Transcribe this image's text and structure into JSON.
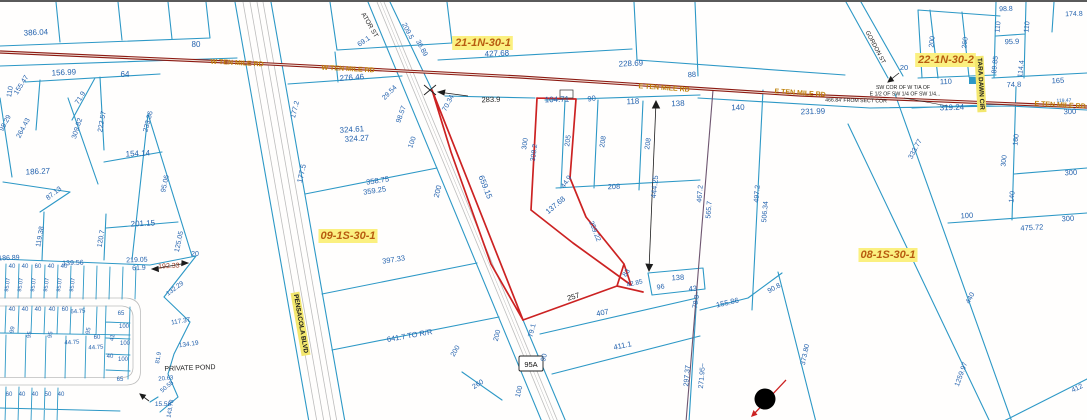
{
  "map": {
    "shield": "95A",
    "colors": {
      "parcel_line": "#2d98c6",
      "dimension_label": "#2563ae",
      "road_centerline": "#8c1a12",
      "highlighted_parcel": "#cc2222",
      "section_label_text": "#b85c10",
      "label_highlight": "#fbf080",
      "street_label_highlight": "#f3e76e",
      "corridor_gray": "#bdbdbd",
      "quarter_section_line": "#6e5570",
      "road_name_text": "#bf8109",
      "black_text": "#1c1c1c",
      "dark_red_dim": "#9a3a20"
    },
    "labels": [
      {
        "t": "386.04",
        "x": 36,
        "y": 33,
        "r": -3,
        "s": 8
      },
      {
        "t": "80",
        "x": 196,
        "y": 45,
        "s": 8
      },
      {
        "t": "156.99",
        "x": 64,
        "y": 73,
        "r": -3,
        "s": 8
      },
      {
        "t": "64",
        "x": 125,
        "y": 75,
        "s": 8
      },
      {
        "t": "110",
        "x": 12,
        "y": 90,
        "r": -80,
        "s": 7
      },
      {
        "t": "155.47",
        "x": 23,
        "y": 84,
        "r": -58,
        "s": 7
      },
      {
        "t": "71.9",
        "x": 82,
        "y": 97,
        "r": -58,
        "s": 7
      },
      {
        "t": "222.57",
        "x": 104,
        "y": 120,
        "r": -80,
        "s": 7
      },
      {
        "t": "98.29",
        "x": 7,
        "y": 122,
        "r": -62,
        "s": 7
      },
      {
        "t": "264.43",
        "x": 25,
        "y": 127,
        "r": -62,
        "s": 7
      },
      {
        "t": "309.82",
        "x": 79,
        "y": 127,
        "r": -72,
        "s": 7
      },
      {
        "t": "233.36",
        "x": 150,
        "y": 120,
        "r": -75,
        "s": 7
      },
      {
        "t": "186.27",
        "x": 38,
        "y": 172,
        "r": -3,
        "s": 8
      },
      {
        "t": "87.13",
        "x": 55,
        "y": 193,
        "r": -38,
        "s": 7
      },
      {
        "t": "154.14",
        "x": 138,
        "y": 154,
        "r": -3,
        "s": 8
      },
      {
        "t": "119.38",
        "x": 42,
        "y": 235,
        "r": -80,
        "s": 7
      },
      {
        "t": "120.7",
        "x": 103,
        "y": 237,
        "r": -80,
        "s": 7
      },
      {
        "t": "201.15",
        "x": 143,
        "y": 224,
        "r": -3,
        "s": 8
      },
      {
        "t": "95.06",
        "x": 167,
        "y": 182,
        "r": -78,
        "s": 7
      },
      {
        "t": "125.05",
        "x": 181,
        "y": 240,
        "r": -78,
        "s": 7
      },
      {
        "t": "20",
        "x": 195,
        "y": 254,
        "s": 7
      },
      {
        "t": "186.89",
        "x": 9,
        "y": 258,
        "r": -2,
        "s": 7
      },
      {
        "t": "139.56",
        "x": 73,
        "y": 263,
        "r": -2,
        "s": 7
      },
      {
        "t": "219.05",
        "x": 137,
        "y": 260,
        "r": -2,
        "s": 7
      },
      {
        "t": "61.9",
        "x": 139,
        "y": 268,
        "r": -2,
        "s": 7
      },
      {
        "t": "192.33",
        "x": 169,
        "y": 266,
        "r": -3,
        "c": "d",
        "s": 7
      },
      {
        "t": "132.29",
        "x": 176,
        "y": 288,
        "r": -36,
        "s": 6.5
      },
      {
        "t": "117.37",
        "x": 181,
        "y": 321,
        "r": -10,
        "s": 6.5
      },
      {
        "t": "134.19",
        "x": 189,
        "y": 344,
        "r": -8,
        "s": 6.5
      },
      {
        "t": "20.63",
        "x": 166,
        "y": 378,
        "r": -6,
        "s": 6
      },
      {
        "t": "50.58",
        "x": 168,
        "y": 386,
        "r": -40,
        "s": 6
      },
      {
        "t": "15.58",
        "x": 163,
        "y": 404,
        "s": 6.5
      },
      {
        "t": "143.78",
        "x": 172,
        "y": 407,
        "r": -80,
        "s": 6
      },
      {
        "t": "81.9",
        "x": 160,
        "y": 356,
        "r": -80,
        "s": 6
      },
      {
        "t": "PRIVATE POND",
        "x": 190,
        "y": 368,
        "r": -2,
        "c": "k",
        "s": 7
      },
      {
        "t": "40",
        "x": 12,
        "y": 266,
        "s": 6
      },
      {
        "t": "40",
        "x": 25,
        "y": 266,
        "s": 6
      },
      {
        "t": "60",
        "x": 38,
        "y": 266,
        "s": 6
      },
      {
        "t": "40",
        "x": 51,
        "y": 266,
        "s": 6
      },
      {
        "t": "40",
        "x": 64,
        "y": 266,
        "s": 6
      },
      {
        "t": "40",
        "x": 12,
        "y": 309,
        "s": 6
      },
      {
        "t": "40",
        "x": 25,
        "y": 309,
        "s": 6
      },
      {
        "t": "40",
        "x": 38,
        "y": 309,
        "s": 6
      },
      {
        "t": "40",
        "x": 52,
        "y": 309,
        "s": 6
      },
      {
        "t": "60",
        "x": 65,
        "y": 309,
        "s": 6
      },
      {
        "t": "64.75",
        "x": 78,
        "y": 311,
        "r": -3,
        "s": 6
      },
      {
        "t": "95.07",
        "x": 9,
        "y": 283,
        "r": -82,
        "s": 5.5
      },
      {
        "t": "95.07",
        "x": 22,
        "y": 283,
        "r": -82,
        "s": 5.5
      },
      {
        "t": "95.07",
        "x": 35,
        "y": 283,
        "r": -82,
        "s": 5.5
      },
      {
        "t": "95.07",
        "x": 48,
        "y": 283,
        "r": -82,
        "s": 5.5
      },
      {
        "t": "95.07",
        "x": 61,
        "y": 283,
        "r": -82,
        "s": 5.5
      },
      {
        "t": "95.07",
        "x": 74,
        "y": 283,
        "r": -82,
        "s": 5.5
      },
      {
        "t": "99",
        "x": 14,
        "y": 328,
        "r": -80,
        "s": 6
      },
      {
        "t": "95",
        "x": 31,
        "y": 333,
        "r": -80,
        "s": 6
      },
      {
        "t": "95",
        "x": 52,
        "y": 333,
        "r": -80,
        "s": 6
      },
      {
        "t": "95",
        "x": 90,
        "y": 329,
        "r": -80,
        "s": 6
      },
      {
        "t": "44.75",
        "x": 72,
        "y": 342,
        "r": -3,
        "s": 6
      },
      {
        "t": "44.75",
        "x": 96,
        "y": 347,
        "r": -3,
        "s": 6
      },
      {
        "t": "60",
        "x": 97,
        "y": 337,
        "s": 6
      },
      {
        "t": "65",
        "x": 121,
        "y": 313,
        "s": 6
      },
      {
        "t": "41",
        "x": 114,
        "y": 336,
        "r": -80,
        "s": 6
      },
      {
        "t": "100",
        "x": 124,
        "y": 326,
        "s": 6
      },
      {
        "t": "100",
        "x": 125,
        "y": 343,
        "s": 6
      },
      {
        "t": "100",
        "x": 123,
        "y": 359,
        "s": 6
      },
      {
        "t": "40",
        "x": 110,
        "y": 356,
        "s": 6
      },
      {
        "t": "65",
        "x": 120,
        "y": 379,
        "s": 6
      },
      {
        "t": "60",
        "x": 9,
        "y": 394,
        "s": 6
      },
      {
        "t": "40",
        "x": 22,
        "y": 394,
        "s": 6
      },
      {
        "t": "40",
        "x": 35,
        "y": 394,
        "s": 6
      },
      {
        "t": "50",
        "x": 48,
        "y": 394,
        "s": 6
      },
      {
        "t": "40",
        "x": 61,
        "y": 394,
        "s": 6
      },
      {
        "t": "276.46",
        "x": 352,
        "y": 78,
        "r": -4,
        "s": 8
      },
      {
        "t": "177.2",
        "x": 297,
        "y": 108,
        "r": -76,
        "s": 7
      },
      {
        "t": "324.61",
        "x": 352,
        "y": 130,
        "r": -4,
        "s": 8
      },
      {
        "t": "324.27",
        "x": 357,
        "y": 139,
        "r": -4,
        "s": 8
      },
      {
        "t": "29.54",
        "x": 391,
        "y": 92,
        "r": -45,
        "s": 7
      },
      {
        "t": "98.57",
        "x": 403,
        "y": 113,
        "r": -70,
        "s": 7
      },
      {
        "t": "100",
        "x": 414,
        "y": 141,
        "r": -70,
        "s": 7
      },
      {
        "t": "177.5",
        "x": 304,
        "y": 172,
        "r": -77,
        "s": 7.5
      },
      {
        "t": "358.75",
        "x": 378,
        "y": 181,
        "r": -9,
        "s": 7.5
      },
      {
        "t": "359.25",
        "x": 375,
        "y": 191,
        "r": -9,
        "s": 7.5
      },
      {
        "t": "200",
        "x": 440,
        "y": 190,
        "r": -76,
        "s": 7.5
      },
      {
        "t": "397.33",
        "x": 394,
        "y": 260,
        "r": -9,
        "s": 7.5
      },
      {
        "t": "641.7 TO R/R",
        "x": 410,
        "y": 336,
        "r": -10,
        "s": 7.5
      },
      {
        "t": "260",
        "x": 479,
        "y": 384,
        "r": -32,
        "s": 7
      },
      {
        "t": "200",
        "x": 457,
        "y": 350,
        "r": -60,
        "s": 7
      },
      {
        "t": "200",
        "x": 499,
        "y": 334,
        "r": -76,
        "s": 7
      },
      {
        "t": "100",
        "x": 521,
        "y": 390,
        "r": -76,
        "s": 7
      },
      {
        "t": "90",
        "x": 546,
        "y": 356,
        "r": -76,
        "s": 7
      },
      {
        "t": "79.1",
        "x": 534,
        "y": 329,
        "r": -76,
        "s": 7
      },
      {
        "t": "283.9",
        "x": 491,
        "y": 100,
        "r": -2,
        "c": "k",
        "s": 7.5
      },
      {
        "t": "104.71",
        "x": 557,
        "y": 100,
        "r": -2,
        "s": 8
      },
      {
        "t": "90",
        "x": 592,
        "y": 99,
        "r": -8,
        "s": 7.5
      },
      {
        "t": "118",
        "x": 633,
        "y": 102,
        "r": -2,
        "s": 8
      },
      {
        "t": "138",
        "x": 678,
        "y": 104,
        "r": -2,
        "s": 8
      },
      {
        "t": "140",
        "x": 738,
        "y": 108,
        "r": -2,
        "s": 8
      },
      {
        "t": "231.99",
        "x": 813,
        "y": 112,
        "r": -2,
        "s": 8
      },
      {
        "t": "70.34",
        "x": 450,
        "y": 102,
        "r": -62,
        "s": 7
      },
      {
        "t": "659.15",
        "x": 483,
        "y": 186,
        "r": 68,
        "s": 8
      },
      {
        "t": "300",
        "x": 527,
        "y": 142,
        "r": -82,
        "s": 7
      },
      {
        "t": "308.2",
        "x": 536,
        "y": 151,
        "r": -82,
        "s": 7
      },
      {
        "t": "205",
        "x": 570,
        "y": 139,
        "r": -82,
        "s": 7
      },
      {
        "t": "208",
        "x": 605,
        "y": 140,
        "r": -82,
        "s": 7
      },
      {
        "t": "208",
        "x": 650,
        "y": 142,
        "r": -82,
        "s": 7
      },
      {
        "t": "208",
        "x": 614,
        "y": 187,
        "r": -2,
        "s": 7.5
      },
      {
        "t": "444.25",
        "x": 657,
        "y": 185,
        "r": -84,
        "s": 7.5
      },
      {
        "t": "44.9",
        "x": 568,
        "y": 181,
        "r": -55,
        "s": 7
      },
      {
        "t": "137.68",
        "x": 557,
        "y": 205,
        "r": -40,
        "s": 7.5
      },
      {
        "t": "259.22",
        "x": 593,
        "y": 230,
        "r": 68,
        "s": 7
      },
      {
        "t": "257",
        "x": 574,
        "y": 297,
        "r": -16,
        "c": "k",
        "s": 7.5
      },
      {
        "t": "83",
        "x": 628,
        "y": 272,
        "r": -55,
        "s": 7
      },
      {
        "t": "42.85",
        "x": 635,
        "y": 283,
        "r": -12,
        "s": 6.5
      },
      {
        "t": "96",
        "x": 661,
        "y": 287,
        "r": -10,
        "s": 7
      },
      {
        "t": "138",
        "x": 678,
        "y": 278,
        "r": -3,
        "s": 7.5
      },
      {
        "t": "43",
        "x": 693,
        "y": 289,
        "r": -5,
        "s": 7.5
      },
      {
        "t": "407",
        "x": 603,
        "y": 313,
        "r": -12,
        "s": 7.5
      },
      {
        "t": "411.1",
        "x": 623,
        "y": 346,
        "r": -12,
        "s": 7.5
      },
      {
        "t": "78.3",
        "x": 698,
        "y": 300,
        "r": -80,
        "s": 7
      },
      {
        "t": "155.86",
        "x": 728,
        "y": 303,
        "r": -13,
        "s": 7.5
      },
      {
        "t": "90.8",
        "x": 775,
        "y": 288,
        "r": -28,
        "s": 7
      },
      {
        "t": "297.37",
        "x": 689,
        "y": 374,
        "r": -85,
        "s": 7
      },
      {
        "t": "271.95~",
        "x": 704,
        "y": 374,
        "r": -85,
        "s": 7
      },
      {
        "t": "373.80",
        "x": 807,
        "y": 353,
        "r": -78,
        "s": 7
      },
      {
        "t": "1259.97",
        "x": 963,
        "y": 373,
        "r": -70,
        "s": 7
      },
      {
        "t": "412",
        "x": 1078,
        "y": 388,
        "r": -25,
        "s": 7
      },
      {
        "t": "467.2",
        "x": 702,
        "y": 192,
        "r": -85,
        "s": 7
      },
      {
        "t": "565.7",
        "x": 711,
        "y": 208,
        "r": -85,
        "s": 7
      },
      {
        "t": "497.2",
        "x": 759,
        "y": 192,
        "r": -85,
        "s": 7
      },
      {
        "t": "506.34",
        "x": 767,
        "y": 210,
        "r": -85,
        "s": 7
      },
      {
        "t": "ATOR ST",
        "x": 368,
        "y": 24,
        "r": 60,
        "c": "k",
        "s": 6.5
      },
      {
        "t": "209.5",
        "x": 406,
        "y": 30,
        "r": 62,
        "s": 7
      },
      {
        "t": "36.89",
        "x": 420,
        "y": 47,
        "r": 62,
        "s": 7
      },
      {
        "t": "69.1",
        "x": 365,
        "y": 41,
        "r": -35,
        "s": 7
      },
      {
        "t": "427.68",
        "x": 497,
        "y": 54,
        "r": -3,
        "s": 8
      },
      {
        "t": "21-1N-30-1",
        "x": 483,
        "y": 44,
        "c": "sec",
        "s": 11
      },
      {
        "t": "228.69",
        "x": 631,
        "y": 64,
        "r": -3,
        "s": 8
      },
      {
        "t": "88",
        "x": 692,
        "y": 75,
        "r": -3,
        "s": 7.5
      },
      {
        "t": "22-1N-30-2",
        "x": 946,
        "y": 61,
        "c": "sec",
        "s": 11
      },
      {
        "t": "SW COR OF W T/A OF",
        "x": 903,
        "y": 87,
        "c": "k",
        "s": 5.2
      },
      {
        "t": "E 1/2 OF SW 1/4 OF SW 1/4...",
        "x": 905,
        "y": 93.5,
        "c": "k",
        "s": 5.2
      },
      {
        "t": "466.84' FROM SECT COR",
        "x": 856,
        "y": 100,
        "r": 1,
        "c": "k",
        "s": 5.2
      },
      {
        "t": "319.24",
        "x": 952,
        "y": 108,
        "r": -2,
        "s": 8
      },
      {
        "t": "20",
        "x": 904,
        "y": 68,
        "s": 7.5
      },
      {
        "t": "110",
        "x": 946,
        "y": 82,
        "r": -2,
        "s": 7.5
      },
      {
        "t": "TARA DAWN CIR",
        "x": 979,
        "y": 82,
        "r": 87,
        "c": "st",
        "s": 6.5
      },
      {
        "t": "GORDON ST",
        "x": 874,
        "y": 46,
        "r": 62,
        "c": "k",
        "s": 6
      },
      {
        "t": "200",
        "x": 934,
        "y": 40,
        "r": -84,
        "s": 7
      },
      {
        "t": "260",
        "x": 967,
        "y": 41,
        "r": -84,
        "s": 7
      },
      {
        "t": "110",
        "x": 1000,
        "y": 25,
        "r": -84,
        "s": 7
      },
      {
        "t": "110",
        "x": 1029,
        "y": 25,
        "r": -84,
        "s": 7
      },
      {
        "t": "95.9",
        "x": 1012,
        "y": 42,
        "r": -2,
        "s": 7.5
      },
      {
        "t": "89.85",
        "x": 997,
        "y": 63,
        "r": -84,
        "s": 7
      },
      {
        "t": "114.4",
        "x": 1023,
        "y": 67,
        "r": -84,
        "s": 7
      },
      {
        "t": "74.8",
        "x": 1014,
        "y": 85,
        "r": -2,
        "s": 7.5
      },
      {
        "t": "165",
        "x": 1058,
        "y": 81,
        "r": -2,
        "s": 7.5
      },
      {
        "t": "119.47",
        "x": 1064,
        "y": 100,
        "r": -2,
        "s": 5
      },
      {
        "t": "300",
        "x": 1070,
        "y": 112,
        "r": -2,
        "s": 7.5
      },
      {
        "t": "98.8",
        "x": 1006,
        "y": 9,
        "r": -2,
        "s": 7
      },
      {
        "t": "174.8",
        "x": 1074,
        "y": 14,
        "r": -2,
        "s": 7
      },
      {
        "t": "08-1S-30-1",
        "x": 888,
        "y": 256,
        "c": "sec",
        "s": 11
      },
      {
        "t": "09-1S-30-1",
        "x": 348,
        "y": 237,
        "c": "sec",
        "s": 11
      },
      {
        "t": "PENSACOLA BLVD",
        "x": 299,
        "y": 322,
        "r": 80,
        "c": "st",
        "s": 6.5
      },
      {
        "t": "W TEN MILE RD",
        "x": 237,
        "y": 63,
        "r": 3,
        "c": "g",
        "s": 7
      },
      {
        "t": "W TEN MILE RD",
        "x": 348,
        "y": 69,
        "r": 3,
        "c": "g",
        "s": 7
      },
      {
        "t": "E TEN MILE RD",
        "x": 664,
        "y": 88,
        "r": 4,
        "c": "g",
        "s": 7
      },
      {
        "t": "E TEN MILE RD",
        "x": 800,
        "y": 93,
        "r": 4,
        "c": "g",
        "s": 7
      },
      {
        "t": "E TEN MILE RD",
        "x": 1060,
        "y": 105,
        "r": 3,
        "c": "g",
        "s": 7
      },
      {
        "t": "160",
        "x": 1018,
        "y": 138,
        "r": -84,
        "s": 7
      },
      {
        "t": "300",
        "x": 1006,
        "y": 159,
        "r": -84,
        "s": 7
      },
      {
        "t": "300",
        "x": 1071,
        "y": 173,
        "r": -3,
        "s": 7.5
      },
      {
        "t": "140",
        "x": 1014,
        "y": 195,
        "r": -84,
        "s": 7
      },
      {
        "t": "100",
        "x": 967,
        "y": 216,
        "r": -3,
        "s": 7.5
      },
      {
        "t": "475.72",
        "x": 1032,
        "y": 228,
        "r": -3,
        "s": 7.5
      },
      {
        "t": "300",
        "x": 1068,
        "y": 219,
        "r": -3,
        "s": 7.5
      },
      {
        "t": "440",
        "x": 972,
        "y": 297,
        "r": -62,
        "s": 7
      },
      {
        "t": "333.77",
        "x": 917,
        "y": 148,
        "r": -62,
        "s": 7
      }
    ]
  }
}
